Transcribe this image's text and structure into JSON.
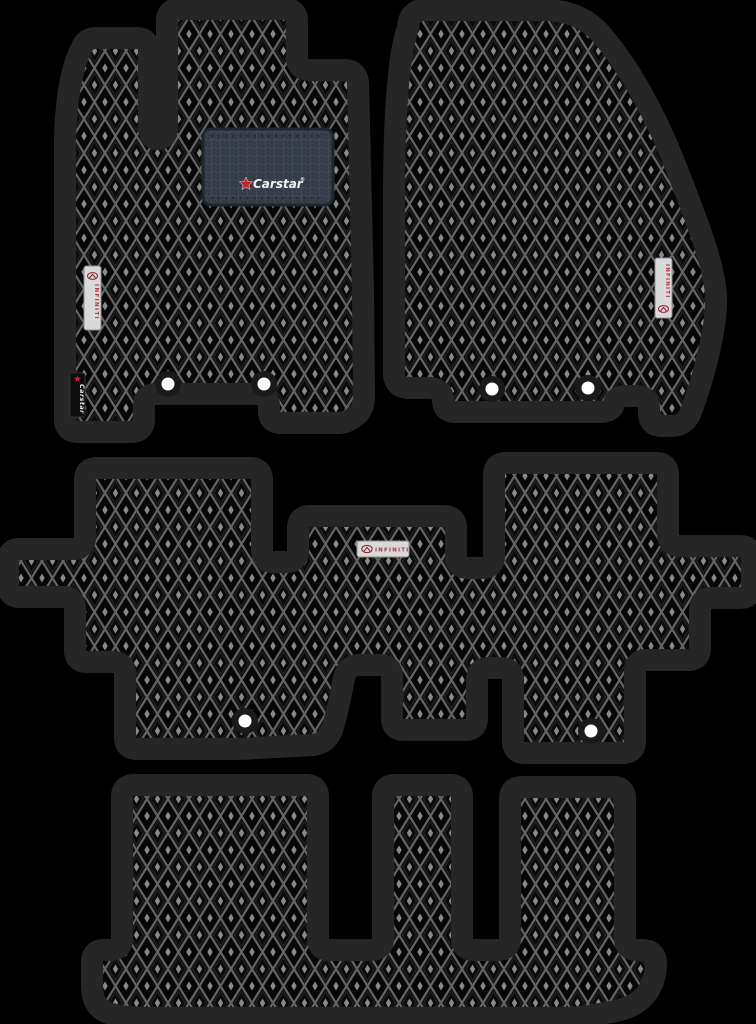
{
  "image": {
    "kind": "product-photo",
    "subject": "EVA car floor mat set, 4 pieces (driver, passenger, second row one-piece, third row)",
    "background_color": "#000000"
  },
  "branding": {
    "heel_logo_text": "Carstar",
    "heel_logo_mark": "®",
    "side_tag_text": "Carstar",
    "infiniti_text": "INFINITI"
  },
  "colors": {
    "background": "#000000",
    "mat_border": "#262626",
    "mat_surface": "#070707",
    "pattern_line": "#6a6a6a",
    "heel_pad": "#39404c",
    "tag_white": "#d9d9d9",
    "tag_black": "#0c0c0c",
    "brand_red": "#c8202f",
    "brand_white": "#f2f2f2",
    "fastener_white": "#ffffff",
    "fastener_ring": "#1a1a1a"
  },
  "mats": [
    {
      "id": "front-left-driver",
      "heel_pad": true,
      "fasteners": 2,
      "tags": [
        "infiniti-vertical",
        "carstar-vertical"
      ]
    },
    {
      "id": "front-right-passenger",
      "heel_pad": false,
      "fasteners": 2,
      "tags": [
        "infiniti-vertical"
      ]
    },
    {
      "id": "second-row",
      "heel_pad": false,
      "fasteners": 2,
      "tags": [
        "infiniti-horizontal"
      ]
    },
    {
      "id": "third-row",
      "heel_pad": false,
      "fasteners": 0,
      "tags": []
    }
  ]
}
